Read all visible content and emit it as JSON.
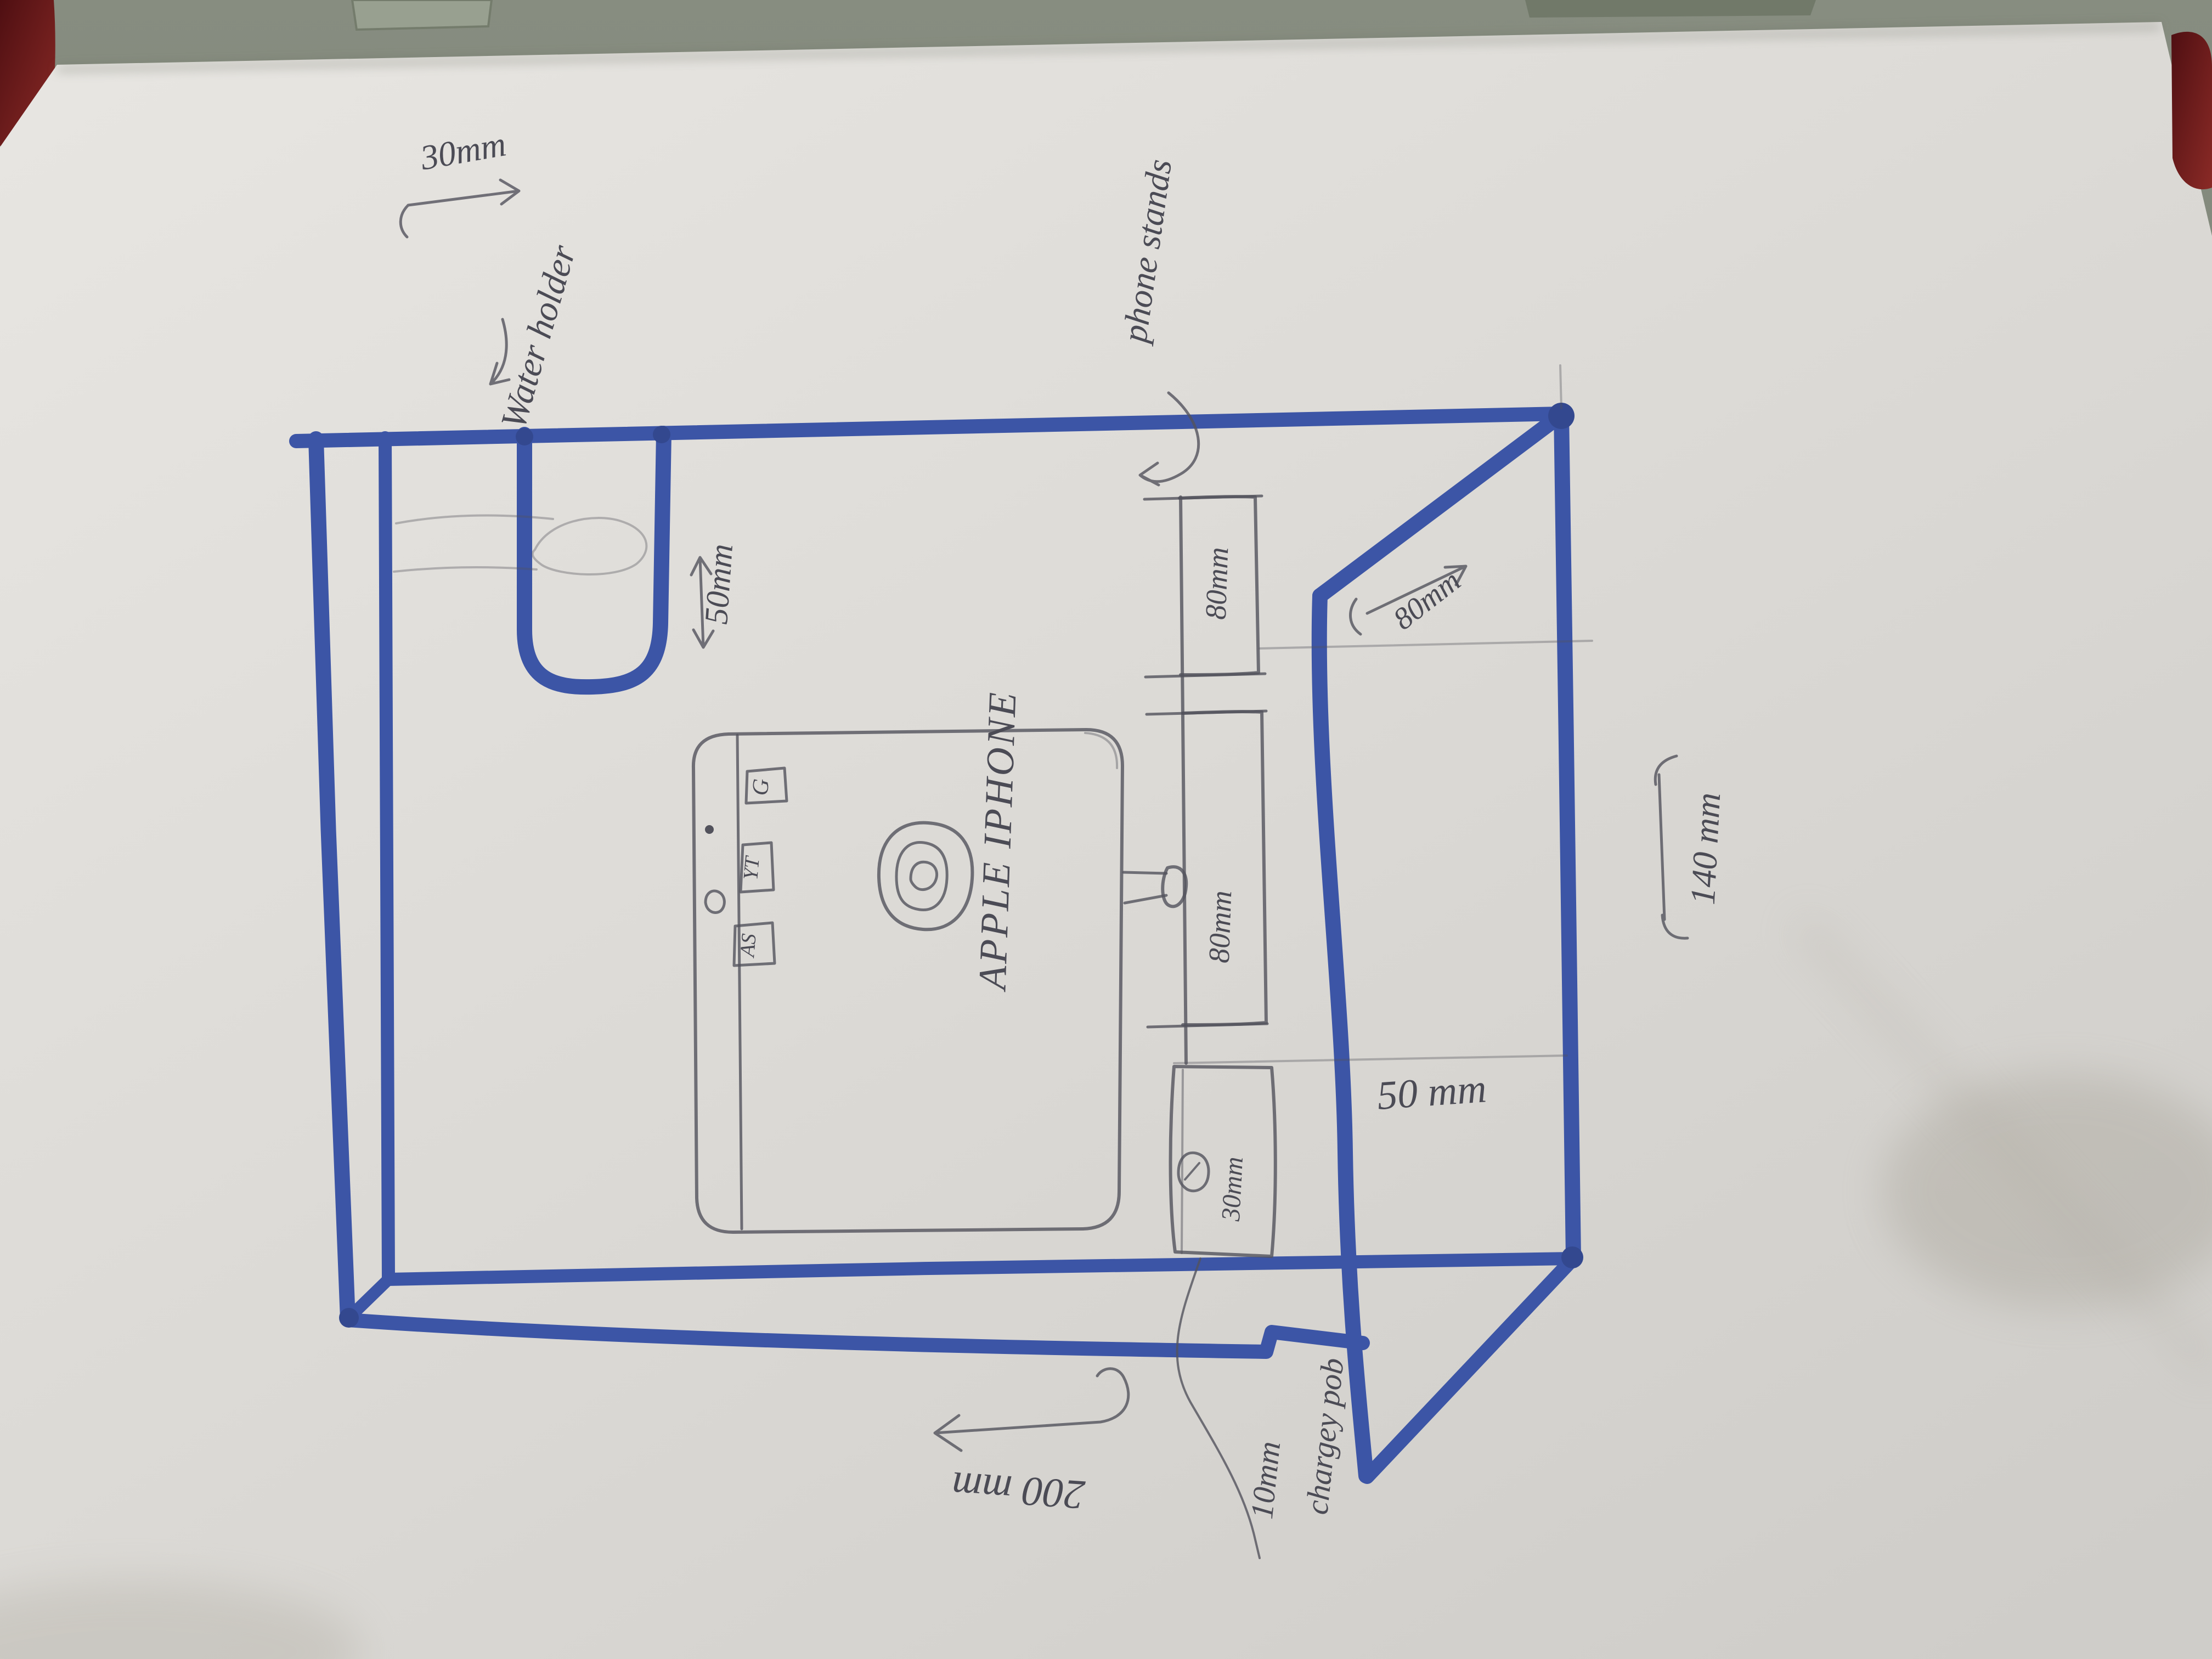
{
  "colors": {
    "marker_blue": "#3c55a6",
    "pencil_gray": "#52525c",
    "paper": "#dfddd9",
    "table": "#7e8477",
    "red_object": "#6e1b1e"
  },
  "labels": {
    "water_holder": "Water holder",
    "notch_width": "30mm",
    "notch_depth": "50mm",
    "phone_stands": "phone stands",
    "bar_upper": "80mm",
    "bar_lower": "80mm",
    "side_depth": "80mm",
    "pod_width": "30mm",
    "pod_gap": "50 mm",
    "charger_size": "10mm",
    "charger_name": "chargey pob",
    "base_width": "200 mm",
    "side_width": "140 mm"
  },
  "phone": {
    "brand": "APPLE IPHONE",
    "icons": [
      "G",
      "YT",
      "AS"
    ]
  }
}
